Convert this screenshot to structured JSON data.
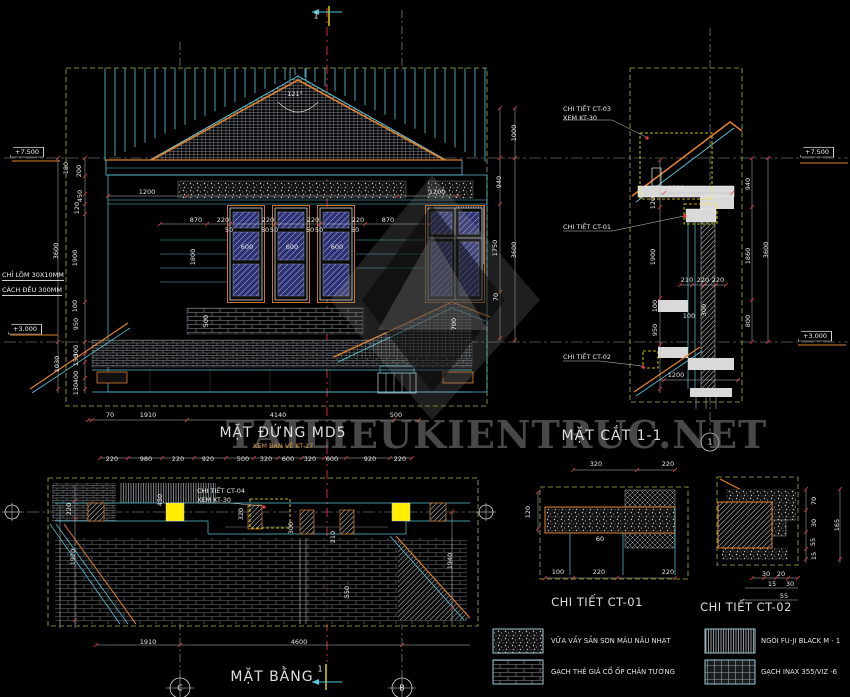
{
  "watermark": {
    "text": "TAILIEUKIENTRUC.NET"
  },
  "markers": {
    "top_section": "1",
    "plan_section": "1",
    "section_grid": "1",
    "plan_grid_left": "C",
    "plan_grid_right": "B"
  },
  "levels": {
    "elev_top": "+7.500",
    "elev_bottom": "+3.000",
    "sect_top": "+7.500",
    "sect_bottom": "+3.000"
  },
  "side_notes": {
    "line1": "CHỈ LÕM 30X10MM",
    "line2": "CÁCH ĐỀU 300MM"
  },
  "elevation": {
    "title": "MẶT ĐỨNG MD5",
    "subtitle": "XEM BẢN VẼ KT-17",
    "roof_angle": "121°",
    "dim_top_left": "1200",
    "dim_top_right": "1200",
    "axis_row": [
      "870",
      "220",
      "220",
      "220",
      "220",
      "870"
    ],
    "window_row": [
      "50",
      "600",
      "50",
      "50",
      "600",
      "50",
      "50",
      "600",
      "50"
    ],
    "window_height": "1800",
    "left_chain_upper": [
      "180",
      "200",
      "450",
      "120",
      "1900"
    ],
    "left_total_upper": "3600",
    "left_chain_lower": [
      "100",
      "950",
      "300",
      "150",
      "400",
      "130"
    ],
    "left_total_lower": "1030",
    "right_chain": [
      "1000",
      "940",
      "1750",
      "70"
    ],
    "right_total": "3600",
    "band_dim": "500",
    "porch_dim": "700",
    "bottom_row": [
      "70",
      "1910",
      "4140",
      "500"
    ]
  },
  "section": {
    "title": "MẶT CẮT 1-1",
    "callout_ct03_line1": "CHI TIẾT CT-03",
    "callout_ct03_line2": "XEM KT-30",
    "callout_ct01": "CHI TIẾT CT-01",
    "callout_ct02": "CHI TIẾT CT-02",
    "dim_top": "1200",
    "dim_bottom": "1200",
    "left_chain": [
      "120",
      "1900",
      "100",
      "950"
    ],
    "mid_row": [
      "210",
      "220",
      "220"
    ],
    "dim_100": "100",
    "dim_300": "300",
    "right_chain": [
      "940",
      "1860",
      "800"
    ],
    "right_total": "3600"
  },
  "plan": {
    "title": "MẶT BẰNG",
    "callout_ct04_line1": "CHI TIẾT CT-04",
    "callout_ct04_line2": "XEM KT-30",
    "top_row": [
      "220",
      "980",
      "220",
      "920",
      "500",
      "320",
      "600",
      "320",
      "600",
      "920",
      "220"
    ],
    "left_dims": [
      "220",
      "1920"
    ],
    "inner_dims": [
      "450",
      "320",
      "300",
      "210",
      "550"
    ],
    "right_dim": "1940",
    "bottom_row": [
      "1910",
      "4600"
    ]
  },
  "detail_ct01": {
    "title": "CHI TIẾT CT-01",
    "top_row": [
      "320",
      "220"
    ],
    "left_dim": "120",
    "inner_dim": "60",
    "bottom_row": [
      "100",
      "220",
      "220"
    ]
  },
  "detail_ct02": {
    "title": "CHI TIẾT CT-02",
    "right_chain": [
      "70",
      "30",
      "55",
      "15"
    ],
    "right_total": "165",
    "bottom_row": [
      "30",
      "20",
      "15",
      "30",
      "55"
    ]
  },
  "legend": {
    "items": [
      {
        "label": "VỮA VẨY SẦN SON MÀU NÂU NHẠT",
        "swatch": "stipple"
      },
      {
        "label": "NGÓI FU-JI BLACK M - 1",
        "swatch": "roof-tile"
      },
      {
        "label": "GẠCH THẺ GIẢ CỔ ỐP CHÂN TƯỜNG",
        "swatch": "brick"
      },
      {
        "label": "GẠCH INAX 355/VIZ -6",
        "swatch": "grid"
      }
    ]
  },
  "colors": {
    "line_cyan": "#58c8dc",
    "line_orange": "#e0802c",
    "accent_yellow": "#ffee00",
    "boundary_olive": "#a9b23a",
    "centerline_red": "#e03434",
    "text": "#e8e8e8"
  }
}
